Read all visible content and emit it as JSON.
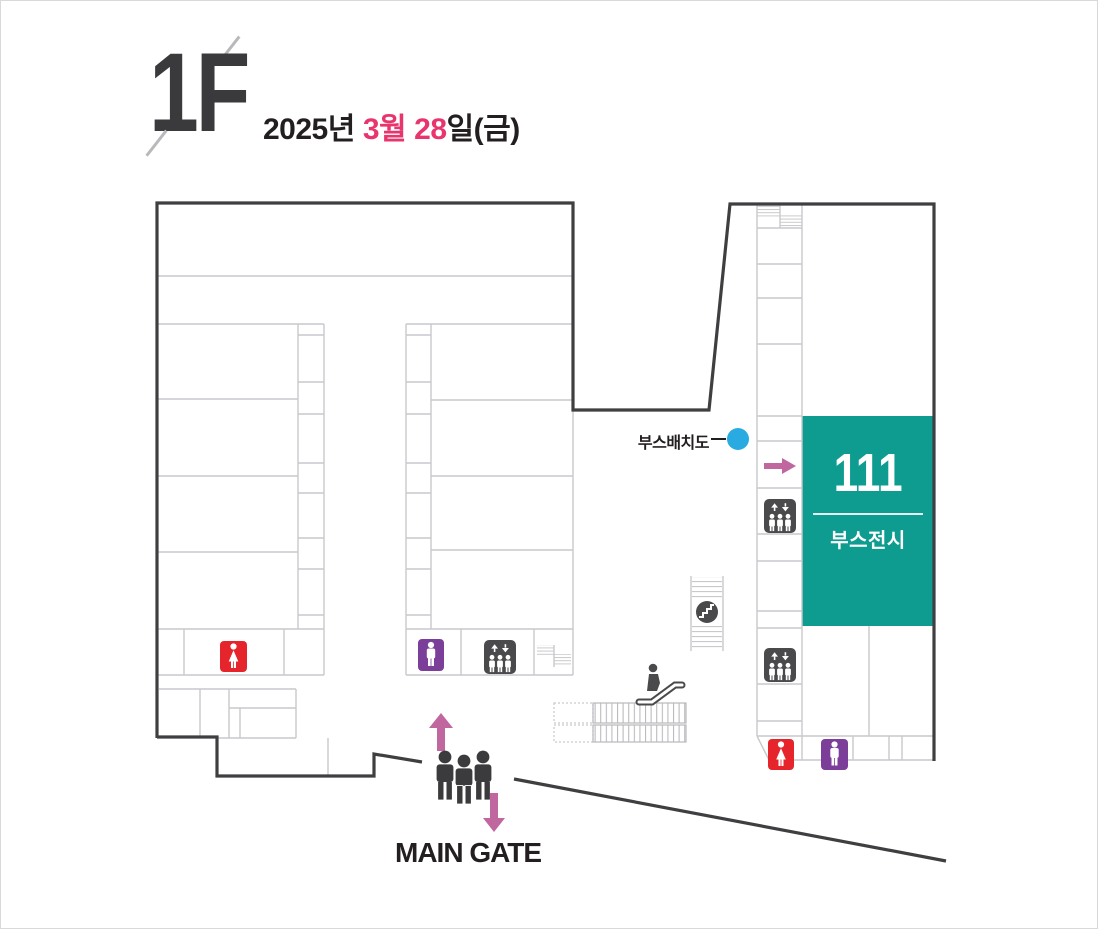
{
  "header": {
    "floor": "1F",
    "date_year": "2025년",
    "date_month": "3월",
    "date_day": "28",
    "date_day_suffix": "일(금)"
  },
  "map": {
    "booth_layout_label": "부스배치도",
    "booth_number": "111",
    "booth_label": "부스전시",
    "main_gate_label": "MAIN GATE"
  },
  "colors": {
    "wall": "#3f3f41",
    "line": "#c9c9cd",
    "teal": "#0d9c8f",
    "red": "#e5242c",
    "purple": "#7c3f99",
    "icon_dark": "#4a4a4c",
    "people": "#3b3b3d",
    "arrow_pink": "#c0679f",
    "date_pink": "#e8356d",
    "blue_dot": "#29abe2",
    "text_dark": "#231f20",
    "title_gray": "#3a3a3c"
  }
}
